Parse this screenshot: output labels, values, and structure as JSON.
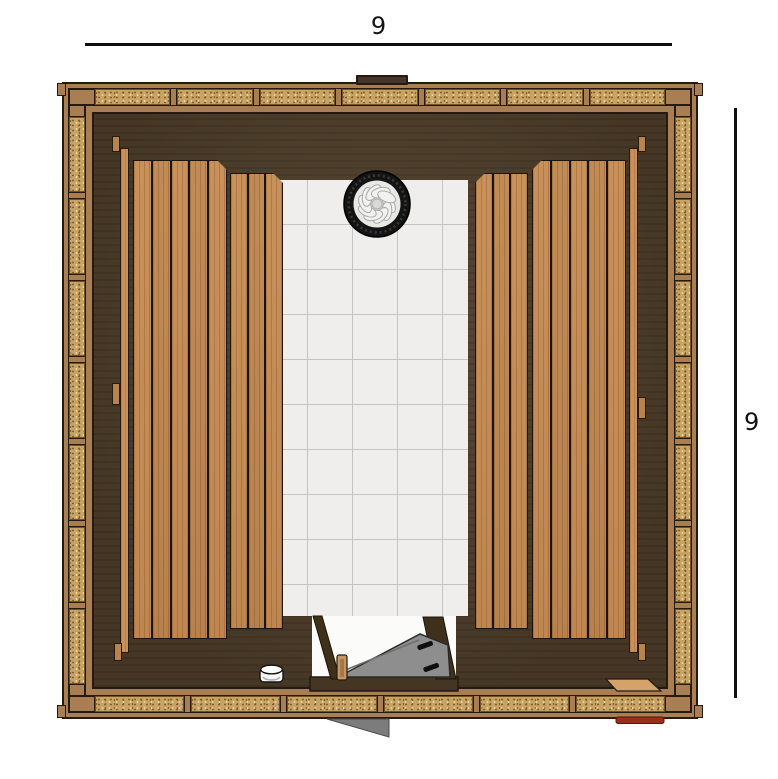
{
  "figure": {
    "type": "floor-plan-top-view",
    "subject": "sauna cabin plan drawing"
  },
  "dimensions": {
    "top_label": "9",
    "right_label": "9"
  },
  "legend": {
    "heater": "round-stone-heater",
    "door": "glass-door-open-inward",
    "bucket": "sauna-bucket",
    "bench_left": "two-tier-bench",
    "bench_right": "two-tier-bench",
    "floor_center": "tiled-walkway",
    "walls": "insulated-timber-frame-walls"
  },
  "palette": {
    "outline": "#241a10",
    "frame_wood": "#a87e52",
    "insulation_fill": "#c8a363",
    "interior_floor": "#4b3a26",
    "bench_wood": "#c9915a",
    "tile": "#efeeec",
    "tile_grid": "#c6c4c0",
    "door_glass": "#8e8e8e",
    "accent_red": "#962f1b",
    "dimension_ink": "#111111"
  }
}
